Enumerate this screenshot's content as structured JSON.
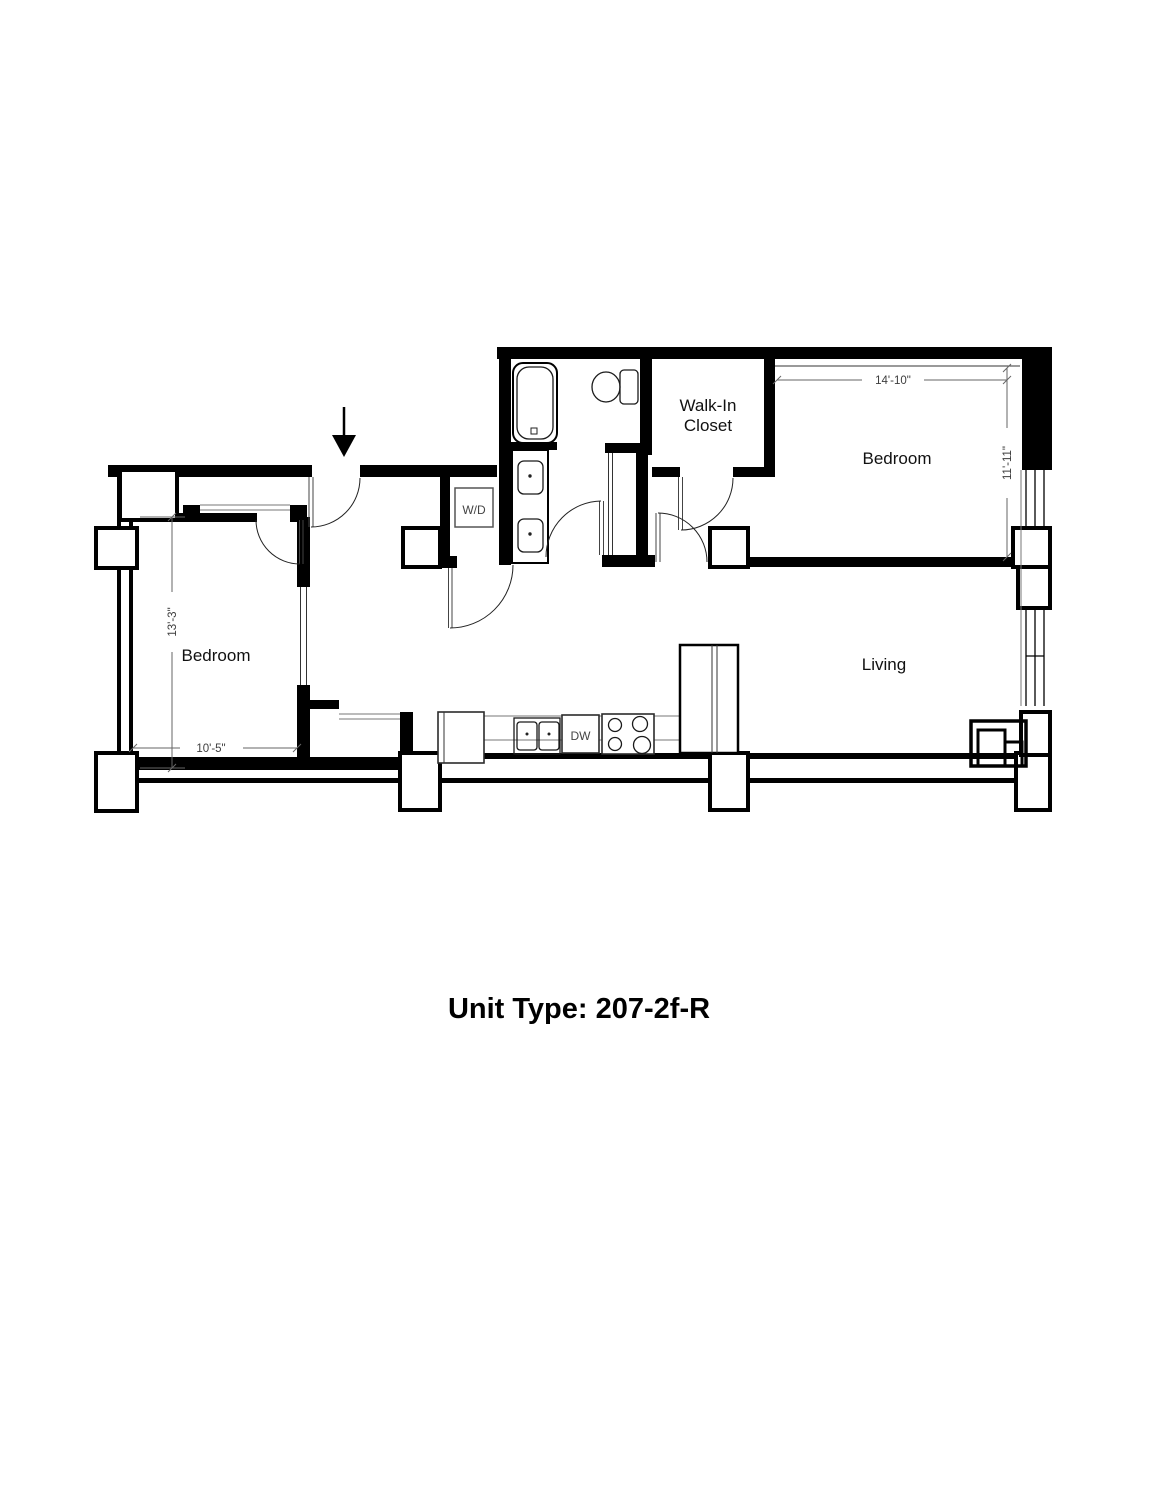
{
  "title": "Unit Type: 207-2f-R",
  "rooms": {
    "bedroom_left": {
      "label": "Bedroom",
      "dim_width": "10'-5\"",
      "dim_height": "13'-3\""
    },
    "bedroom_right": {
      "label": "Bedroom",
      "dim_width": "14'-10\"",
      "dim_height": "11'-11\""
    },
    "walk_in_closet": {
      "line1": "Walk-In",
      "line2": "Closet"
    },
    "living": {
      "label": "Living"
    }
  },
  "fixtures": {
    "washer_dryer": "W/D",
    "dishwasher": "DW"
  },
  "colors": {
    "wall": "#000000",
    "dimension": "#4a4a4a",
    "background": "#ffffff"
  }
}
